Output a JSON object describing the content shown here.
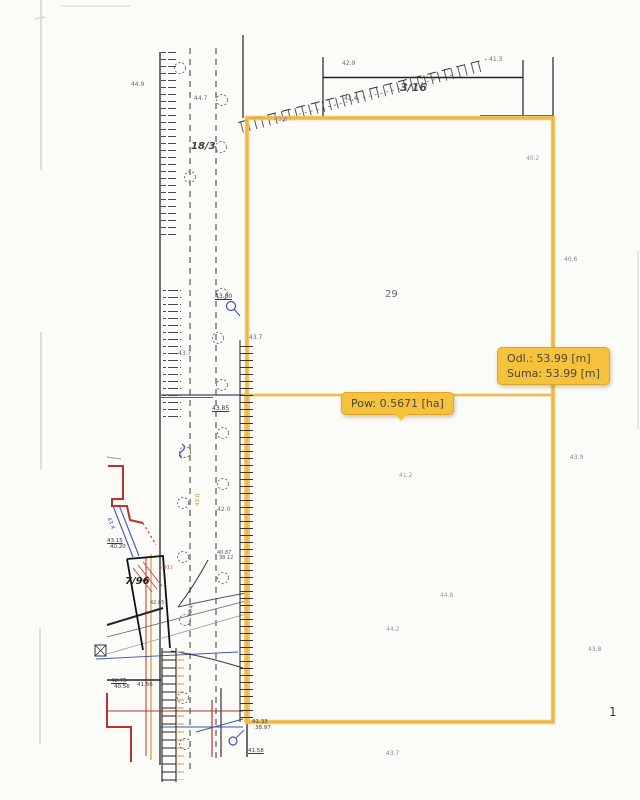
{
  "tooltips": {
    "distance": {
      "line1": "Odl.: 53.99 [m]",
      "line2": "Suma: 53.99 [m]"
    },
    "area": {
      "text": "Pow: 0.5671 [ha]"
    }
  },
  "colors": {
    "highlight": "#F2C14E",
    "highlight_core": "#DFA52F",
    "tooltip_bg": "#F6C23C",
    "tooltip_border": "#DBA82A",
    "tooltip_text": "#4B463A"
  },
  "labels": [
    {
      "t": "44.9",
      "x": 131,
      "y": 82,
      "s": 6,
      "c": "#6b6b6b"
    },
    {
      "t": "44.7",
      "x": 194,
      "y": 96,
      "s": 6,
      "c": "#6b6b6b"
    },
    {
      "t": "18/3",
      "x": 191,
      "y": 142,
      "s": 10,
      "c": "#3c3c3c",
      "b": 1,
      "i": 1,
      "role": "parcel-number"
    },
    {
      "t": "3/16",
      "x": 400,
      "y": 82,
      "s": 11,
      "c": "#4a4a4a",
      "b": 1,
      "i": 1,
      "role": "parcel-number"
    },
    {
      "t": "42.9",
      "x": 342,
      "y": 61,
      "s": 6,
      "c": "#6b6b6b"
    },
    {
      "t": "41.3",
      "x": 489,
      "y": 57,
      "s": 6,
      "c": "#6b6b6b"
    },
    {
      "t": "42.4",
      "x": 344,
      "y": 96,
      "s": 6,
      "c": "#6b6b6b"
    },
    {
      "t": "43.6",
      "x": 274,
      "y": 117,
      "s": 6,
      "c": "#8a8a8a"
    },
    {
      "t": "40.2",
      "x": 526,
      "y": 156,
      "s": 6,
      "c": "#9a9a9a"
    },
    {
      "t": "40.6",
      "x": 564,
      "y": 257,
      "s": 6,
      "c": "#8a8a8a"
    },
    {
      "t": "29",
      "x": 385,
      "y": 290,
      "s": 10,
      "c": "#6a6a6a",
      "role": "parcel-number"
    },
    {
      "t": "43.80",
      "x": 215,
      "y": 294,
      "s": 6,
      "c": "#3a3a3a",
      "u": 1
    },
    {
      "t": "43.7",
      "x": 249,
      "y": 335,
      "s": 6,
      "c": "#6b6b6b"
    },
    {
      "t": "43.7",
      "x": 178,
      "y": 351,
      "s": 6,
      "c": "#6b6b6b"
    },
    {
      "t": "43.85",
      "x": 212,
      "y": 406,
      "s": 6,
      "c": "#3a3a3a",
      "u": 1
    },
    {
      "t": "43.9",
      "x": 570,
      "y": 455,
      "s": 6,
      "c": "#8a8a8a"
    },
    {
      "t": "41.2",
      "x": 399,
      "y": 473,
      "s": 6,
      "c": "#9a9a9a"
    },
    {
      "t": "42.0",
      "x": 217,
      "y": 507,
      "s": 6,
      "c": "#6b6b6b"
    },
    {
      "t": "43.4",
      "x": 110,
      "y": 517,
      "s": 5.5,
      "c": "#3b55b5",
      "r": 68
    },
    {
      "t": "43.0",
      "x": 196,
      "y": 506,
      "s": 5.5,
      "c": "#c08a30",
      "r": -88
    },
    {
      "t": "43.15",
      "x": 107,
      "y": 539,
      "s": 5.5,
      "c": "#3a3a3a",
      "u": 1
    },
    {
      "t": "40.20",
      "x": 110,
      "y": 545,
      "s": 5.5,
      "c": "#3a3a3a"
    },
    {
      "t": "40.87",
      "x": 217,
      "y": 551,
      "s": 5,
      "c": "#555555"
    },
    {
      "t": "38.12",
      "x": 219,
      "y": 556,
      "s": 5,
      "c": "#555555"
    },
    {
      "t": "7/96",
      "x": 125,
      "y": 577,
      "s": 10,
      "c": "#1e1e1e",
      "b": 1,
      "i": 1,
      "role": "parcel-number"
    },
    {
      "t": "(91)",
      "x": 161,
      "y": 566,
      "s": 5.5,
      "c": "#cc5555"
    },
    {
      "t": "42.85",
      "x": 150,
      "y": 601,
      "s": 5,
      "c": "#555555"
    },
    {
      "t": "42.4",
      "x": 188,
      "y": 616,
      "s": 5,
      "c": "#555555",
      "r": -80
    },
    {
      "t": "44.8",
      "x": 440,
      "y": 593,
      "s": 6,
      "c": "#9a9a9a"
    },
    {
      "t": "44.2",
      "x": 386,
      "y": 627,
      "s": 6,
      "c": "#9a9a9a"
    },
    {
      "t": "42.75",
      "x": 111,
      "y": 679,
      "s": 5.5,
      "c": "#3a3a3a",
      "u": 1
    },
    {
      "t": "40.56",
      "x": 114,
      "y": 685,
      "s": 5.5,
      "c": "#3a3a3a"
    },
    {
      "t": "41.56",
      "x": 137,
      "y": 683,
      "s": 5.5,
      "c": "#3a3a3a"
    },
    {
      "t": "41.33",
      "x": 252,
      "y": 720,
      "s": 5.5,
      "c": "#3a3a3a"
    },
    {
      "t": "38.97",
      "x": 255,
      "y": 726,
      "s": 5.5,
      "c": "#3a3a3a"
    },
    {
      "t": "41.58",
      "x": 248,
      "y": 749,
      "s": 5.5,
      "c": "#3a3a3a",
      "u": 1
    },
    {
      "t": "43.7",
      "x": 386,
      "y": 751,
      "s": 6,
      "c": "#8a8a8a"
    },
    {
      "t": "43.8",
      "x": 588,
      "y": 647,
      "s": 6,
      "c": "#8a8a8a"
    },
    {
      "t": "1",
      "x": 609,
      "y": 706,
      "s": 12,
      "c": "#3a3a3a",
      "role": "margin-number"
    }
  ]
}
